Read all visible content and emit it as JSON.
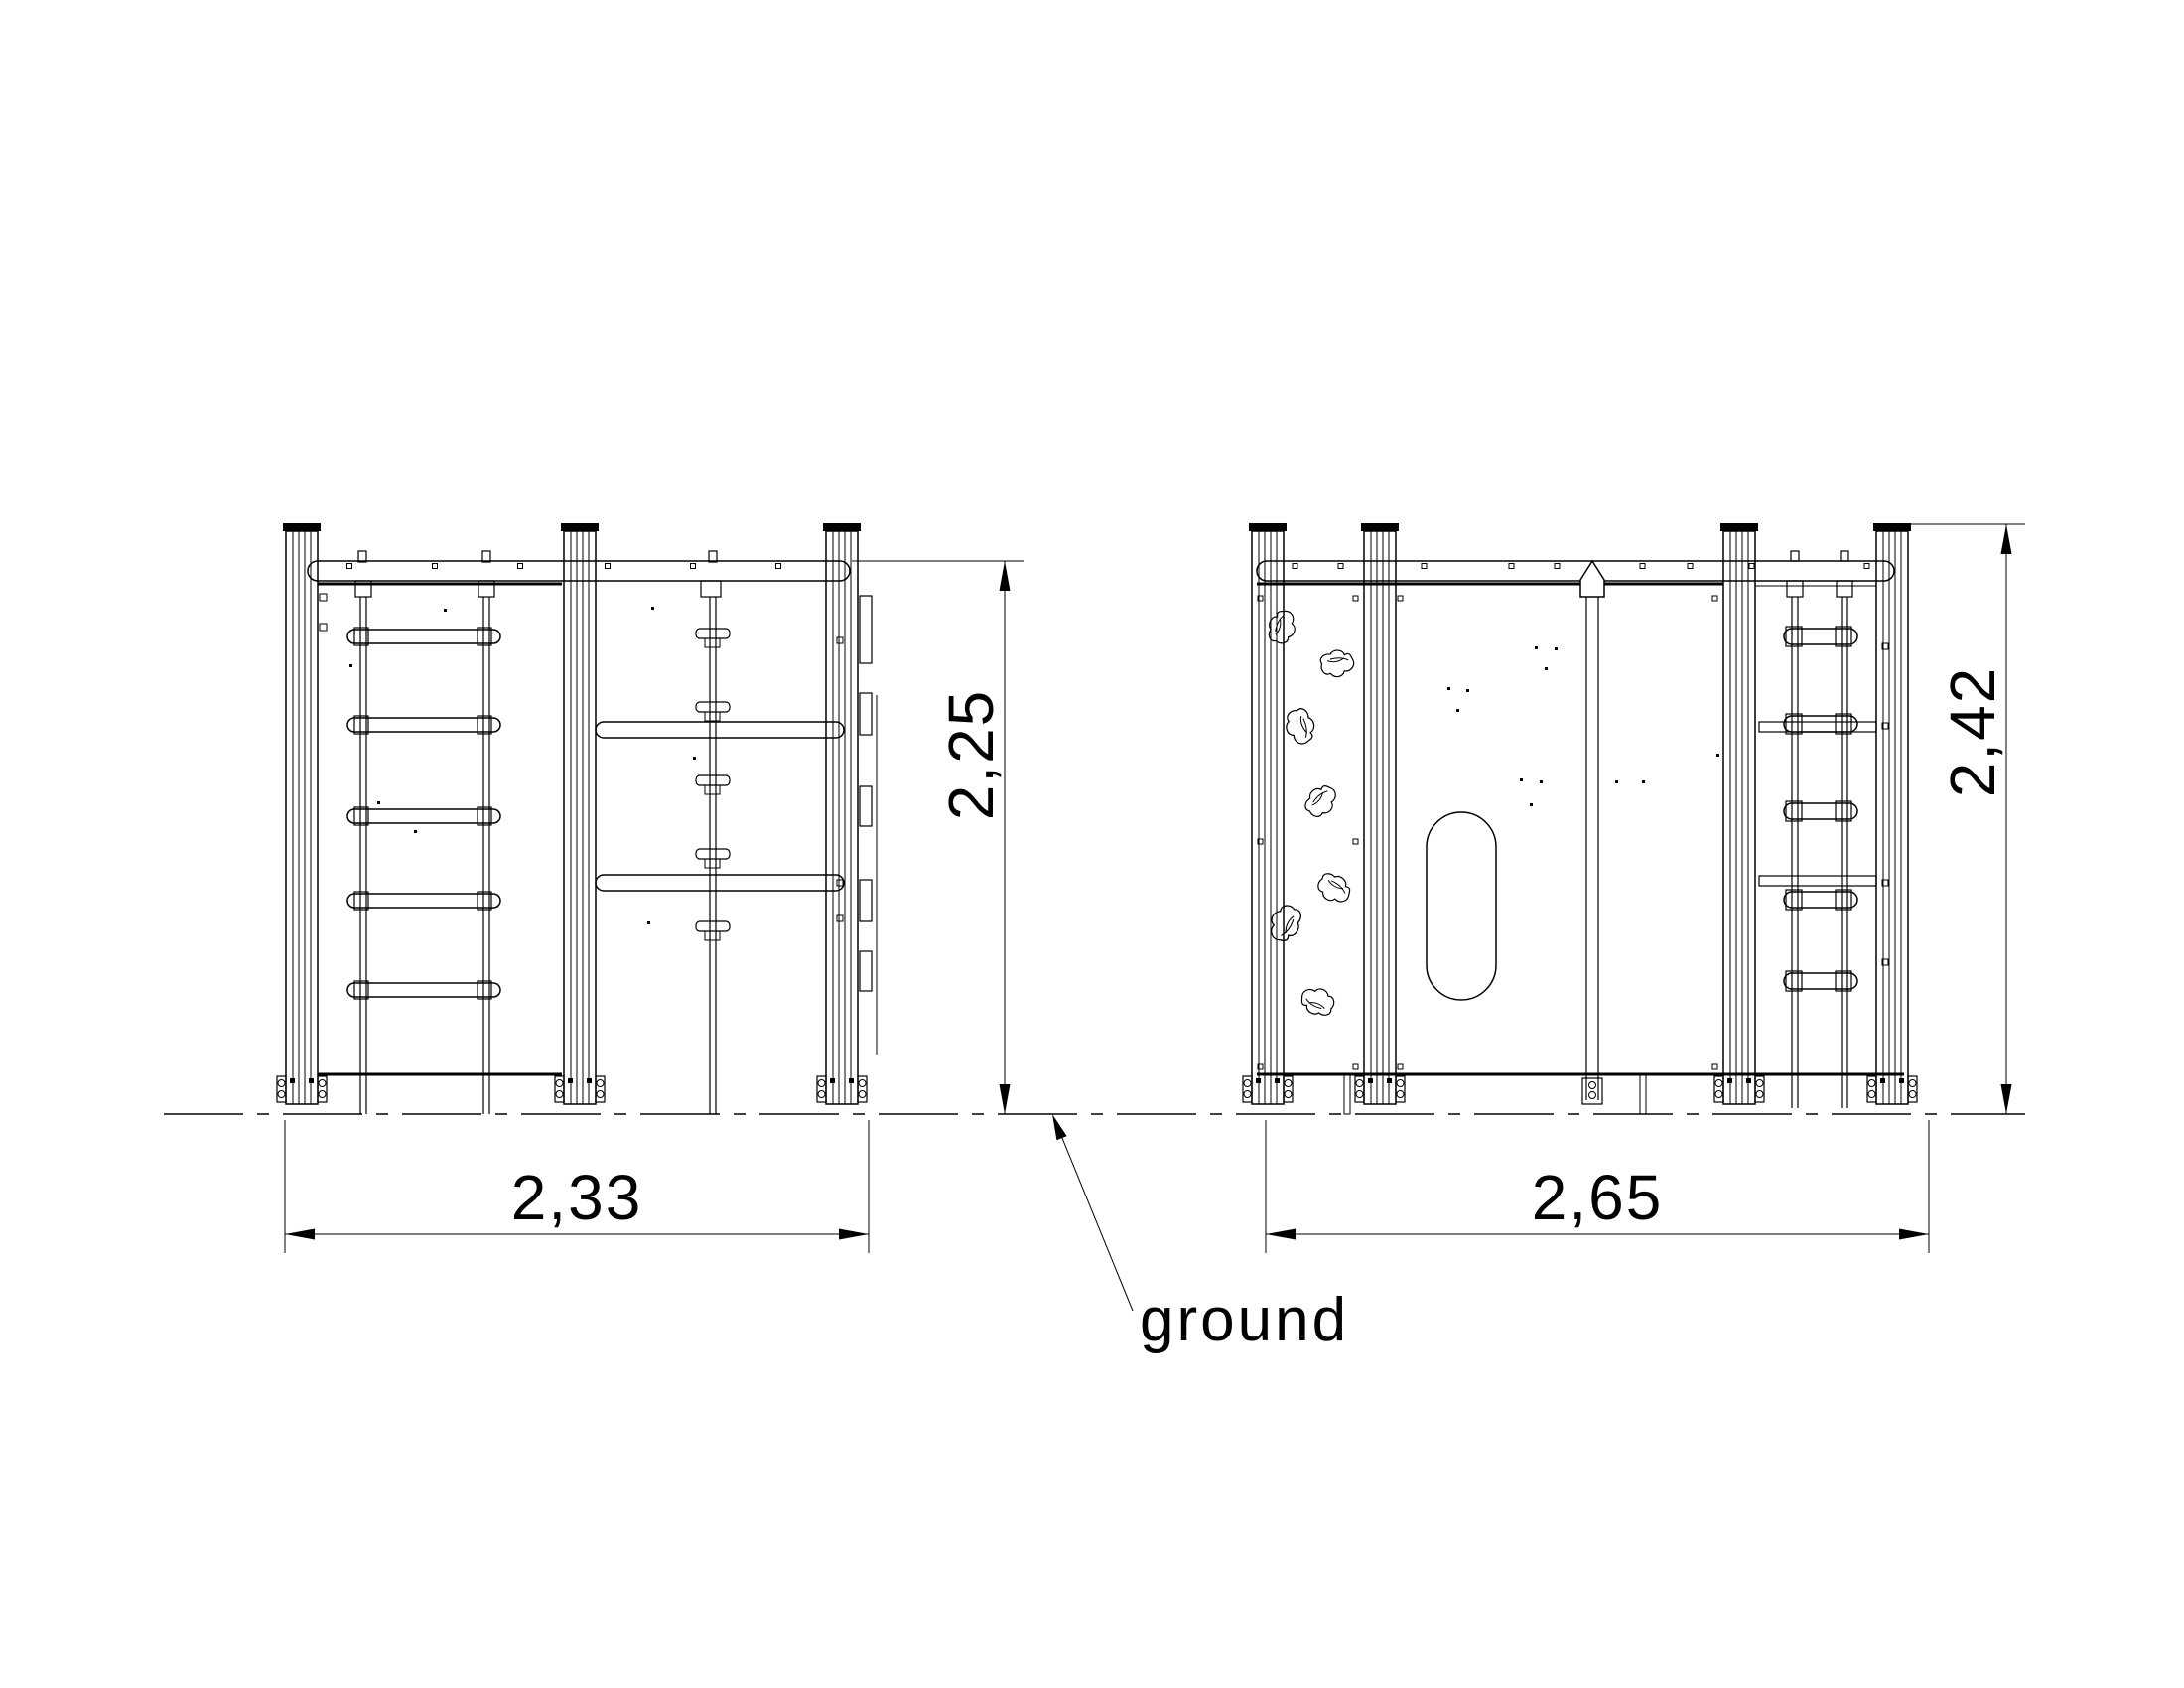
{
  "drawing": {
    "ground_label": "ground",
    "left_view": {
      "width_label": "2,33",
      "height_label": "2,25"
    },
    "right_view": {
      "width_label": "2,65",
      "height_label": "2,42"
    },
    "colors": {
      "line": "#000000",
      "background": "#ffffff"
    }
  }
}
